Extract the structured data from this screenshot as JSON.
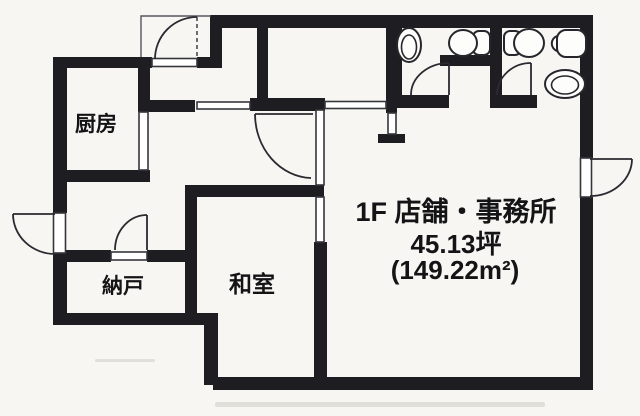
{
  "page": {
    "background": "#f7f6f2",
    "wall_color": "#1d1d22",
    "line_color": "#35353c",
    "text_color": "#141416"
  },
  "floorplan": {
    "main_label": {
      "line1": "1F 店舗・事務所",
      "line2": "45.13坪",
      "line3": "(149.22m²)"
    },
    "rooms": [
      {
        "id": "kitchen",
        "label": "厨房"
      },
      {
        "id": "storage",
        "label": "納戸"
      },
      {
        "id": "japanese-room",
        "label": "和室"
      }
    ],
    "doors": [
      "entrance-door",
      "left-exterior-door",
      "right-exterior-door",
      "hall-main-door",
      "storage-door",
      "toilet-1-door",
      "toilet-2-door"
    ],
    "fixtures": [
      "wash-basin-1",
      "toilet-1",
      "toilet-2",
      "corner-basin",
      "wash-basin-2"
    ]
  }
}
